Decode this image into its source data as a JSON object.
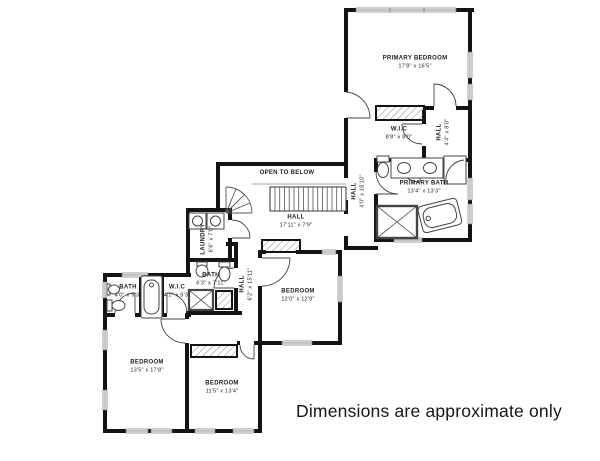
{
  "disclaimer": "Dimensions are approximate only",
  "rooms": {
    "primary_bedroom": {
      "name": "PRIMARY BEDROOM",
      "dims": "17'8\" x 16'5\""
    },
    "primary_wic": {
      "name": "W.I.C",
      "dims": "8'8\" x 8'0\""
    },
    "primary_hall": {
      "name": "HALL",
      "dims": "4'4\" x 8'0\""
    },
    "primary_bath": {
      "name": "PRIMARY BATH",
      "dims": "13'4\" x 13'3\""
    },
    "open_to_below": {
      "name": "OPEN TO BELOW",
      "dims": ""
    },
    "hall_main": {
      "name": "HALL",
      "dims": "17'11\" x 7'9\""
    },
    "hall_upper": {
      "name": "HALL",
      "dims": "4'0\" x 16'10\""
    },
    "laundry": {
      "name": "LAUNDRY",
      "dims": "6'6\" x 7'0\""
    },
    "bath_hall": {
      "name": "BATH",
      "dims": "6'3\" x 7'11\""
    },
    "hall_lower": {
      "name": "HALL",
      "dims": "6'2\" x 15'11\""
    },
    "bath_left": {
      "name": "BATH",
      "dims": "4'0\" x 9'3\""
    },
    "wic_left": {
      "name": "W.I.C",
      "dims": "4'1\" x 9'3\""
    },
    "bedroom_left": {
      "name": "BEDROOM",
      "dims": "13'5\" x 17'8\""
    },
    "bedroom_mid": {
      "name": "BEDROOM",
      "dims": "11'5\" x 13'4\""
    },
    "bedroom_right": {
      "name": "BEDROOM",
      "dims": "12'0\" x 12'9\""
    }
  }
}
